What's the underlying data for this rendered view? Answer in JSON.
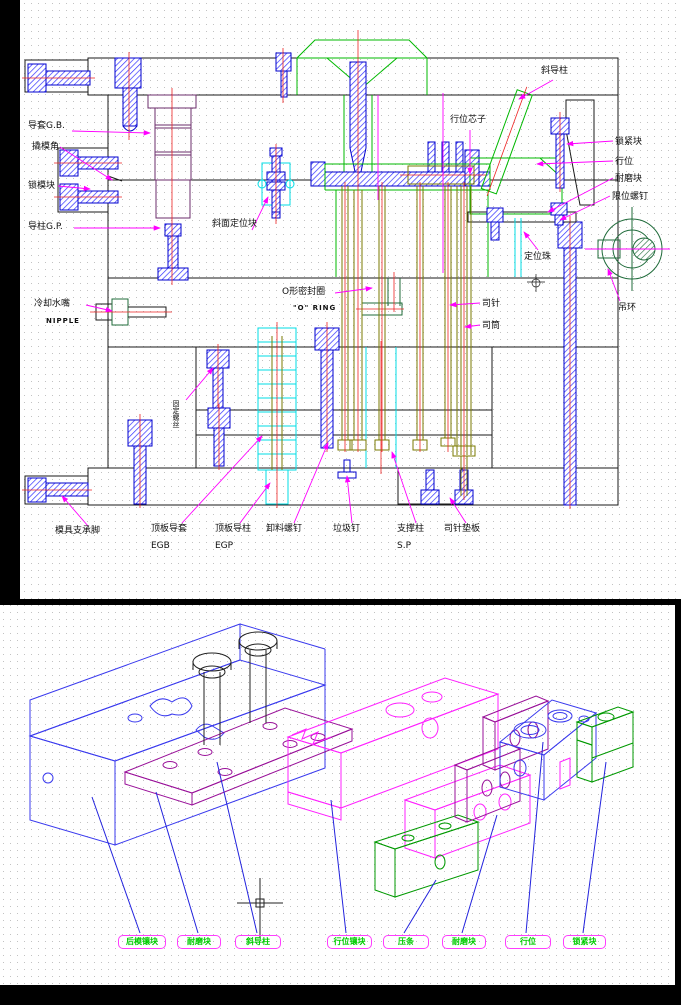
{
  "window": {
    "background": "#000000",
    "panel_color": "#ffffff"
  },
  "top_view": {
    "type": "injection mold cross-section drawing",
    "labels": {
      "guide_bush": "导套G.B.",
      "pry_slot": "撬模角",
      "mold_lock_block": "锁模块",
      "guide_pin": "导柱G.P.",
      "cooling_nipple": "冷却水嘴",
      "cooling_nipple_en": "NIPPLE",
      "mold_support_foot": "模具支承脚",
      "incline_locating_block": "斜面定位块",
      "o_ring": "O形密封圈",
      "o_ring_en": "\"O\" RING",
      "fixing_screw": "固定螺丝",
      "ejector_guide_bush": "顶板导套",
      "ejector_guide_bush_code": "EGB",
      "ejector_guide_pin": "顶板导柱",
      "ejector_guide_pin_code": "EGP",
      "stripper_screw": "卸料螺钉",
      "stop_pin": "垃圾钉",
      "support_pillar": "支撑柱",
      "support_pillar_code": "S.P",
      "ejector_pin_plate": "司针垫板",
      "angle_guide_pin": "斜导柱",
      "slide_core": "行位芯子",
      "locking_block": "锁紧块",
      "slide": "行位",
      "wear_block": "耐磨块",
      "limit_screw": "限位螺钉",
      "locating_ball": "定位珠",
      "ejector_pin": "司针",
      "ejector_sleeve": "司筒",
      "eye_bolt": "吊环"
    }
  },
  "bottom_view": {
    "type": "exploded isometric view of slide assembly",
    "tags": [
      {
        "text": "后模镶块"
      },
      {
        "text": "耐磨块"
      },
      {
        "text": "斜导柱"
      },
      {
        "text": "行位镶块"
      },
      {
        "text": "压条"
      },
      {
        "text": "耐磨块"
      },
      {
        "text": "行位"
      },
      {
        "text": "锁紧块"
      }
    ]
  },
  "colors": {
    "outline": "#1a1a1a",
    "bolt_blue": "#0000cc",
    "centerline_red": "#ee2222",
    "cavity_green": "#00b800",
    "leader_magenta": "#ff00ff",
    "highlight_cyan": "#00dde6",
    "pin_olive": "#7a7a00",
    "tag_border": "#ff3dff",
    "tag_text": "#00cc00",
    "iso_blue": "#3a3aee",
    "iso_magenta": "#ff22ff",
    "iso_purple": "#991099",
    "iso_green": "#009900"
  }
}
